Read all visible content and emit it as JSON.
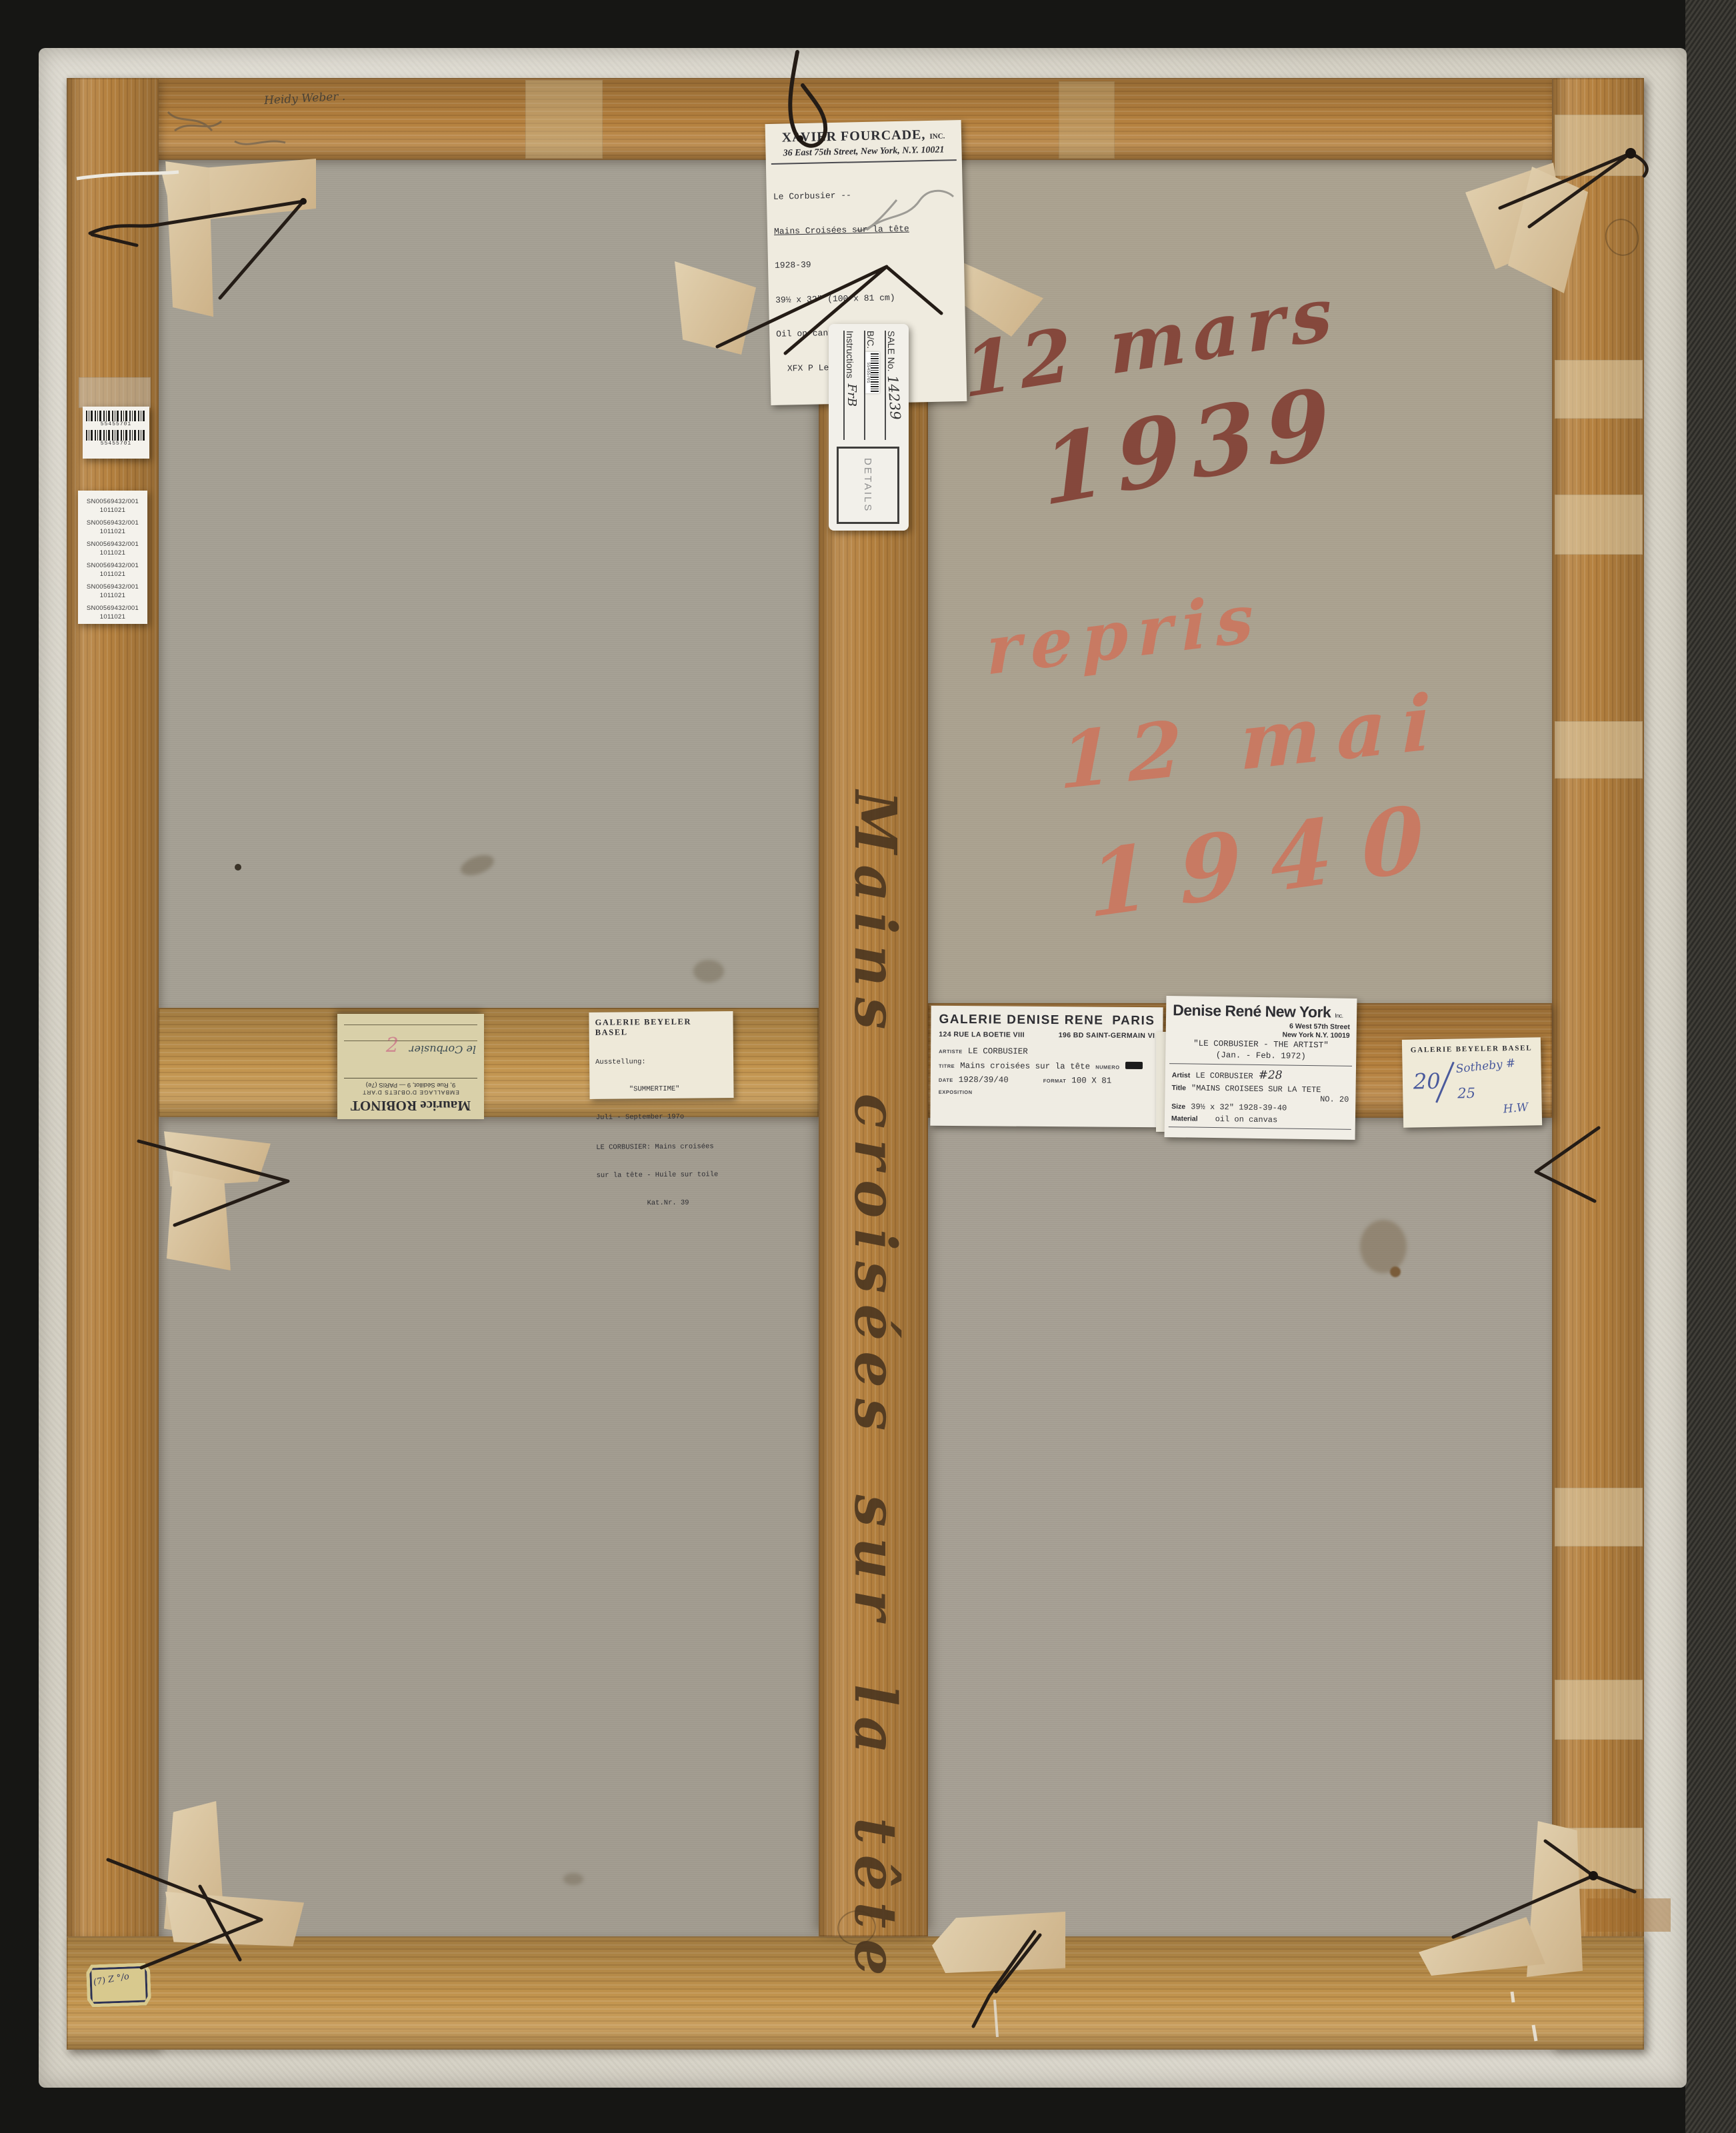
{
  "inscriptions": {
    "pencil": "Heidy Weber .",
    "mars_line1": "12 mars",
    "mars_line2": "1939",
    "repris_line1": "repris",
    "repris_line2": "12 mai",
    "repris_line3": "1940",
    "stretcher_title": "Mains croisées sur la tête"
  },
  "labels": {
    "fourcade": {
      "gallery": "XAVIER FOURCADE,",
      "inc": "INC.",
      "address": "36 East 75th Street, New York, N.Y. 10021",
      "artist_line": "Le Corbusier --",
      "title_line": "Mains Croisées sur la tête",
      "date_line": "1928-39",
      "size_line": "39½ x 32\" (100 x 81 cm)",
      "medium_line": "Oil on canvas",
      "ref_line": "  XFX P Le Corbusier 3847"
    },
    "barcode_label": {
      "barcode1": "55455701",
      "barcode2": "55455701"
    },
    "sn_label": {
      "entries": [
        {
          "sn": "SN00569432/001",
          "no": "1011021"
        },
        {
          "sn": "SN00569432/001",
          "no": "1011021"
        },
        {
          "sn": "SN00569432/001",
          "no": "1011021"
        },
        {
          "sn": "SN00569432/001",
          "no": "1011021"
        },
        {
          "sn": "SN00569432/001",
          "no": "1011021"
        },
        {
          "sn": "SN00569432/001",
          "no": "1011021"
        }
      ]
    },
    "sale_tag": {
      "sale_label": "SALE No.",
      "sale_no": "14239",
      "bc_label": "B/C.",
      "bc_barcode": "55455701",
      "instructions_label": "Instructions",
      "instructions_value": "FrB",
      "details": "DETAILS"
    },
    "robinot": {
      "name": "Maurice ROBINOT",
      "line2": "EMBALLAGE D'OBJETS D'ART",
      "line3": "9, Rue Sédillot, 9 — PARIS (7e)",
      "hand": "le Corbusier",
      "stamp": "2"
    },
    "beyeler_summertime": {
      "gallery": "GALERIE BEYELER BASEL",
      "l1": "Ausstellung:",
      "l2": "        \"SUMMERTIME\"",
      "l3": "Juli - September 197o",
      "l4": "LE CORBUSIER: Mains croisées",
      "l5": "sur la tête - Huile sur toile",
      "l6": "            Kat.Nr. 39"
    },
    "denise_rene_paris": {
      "gallery": "GALERIE DENISE RENE",
      "city": "PARIS",
      "addr1": "124 RUE LA BOETIE VIII",
      "addr2": "196 BD SAINT-GERMAIN VI",
      "artiste_label": "ARTISTE",
      "artiste": "LE CORBUSIER",
      "titre_label": "TITRE",
      "titre": "Mains croisées sur la tête",
      "numero_label": "NUMERO",
      "date_label": "DATE",
      "date": "1928/39/40",
      "format_label": "FORMAT",
      "format": "100 X 81",
      "exposition_label": "EXPOSITION"
    },
    "denise_rene_ny": {
      "gallery": "Denise René New York",
      "inc": "Inc.",
      "addr1": "6 West 57th Street",
      "addr2": "New York N.Y. 10019",
      "expo1": "\"LE CORBUSIER - THE ARTIST\"",
      "expo2": "(Jan. - Feb. 1972)",
      "artist_label": "Artist",
      "artist": "LE CORBUSIER",
      "hand_no": "#28",
      "title_label": "Title",
      "title": "\"MAINS CROISEES SUR LA TETE",
      "no": "NO. 20",
      "size_label": "Size",
      "size": "39½ x 32\"  1928-39-40",
      "material_label": "Material",
      "material": "oil on canvas"
    },
    "beyeler_small": {
      "gallery": "GALERIE BEYELER BASEL",
      "hand_20": "20",
      "hand_25": "25",
      "hand_sotheby": "Sotheby #",
      "hand_hw": "H.W"
    },
    "corner_sticker": {
      "marks": "(7) Z °/o"
    }
  },
  "colors": {
    "wood": "#b5813f",
    "canvas": "#a8a296",
    "lining": "#d7d3c7",
    "maroon_ink": "#803b30",
    "red_ink": "#cb765d",
    "brown_ink": "#4a351f",
    "blue_ink": "#4a5a9c"
  }
}
